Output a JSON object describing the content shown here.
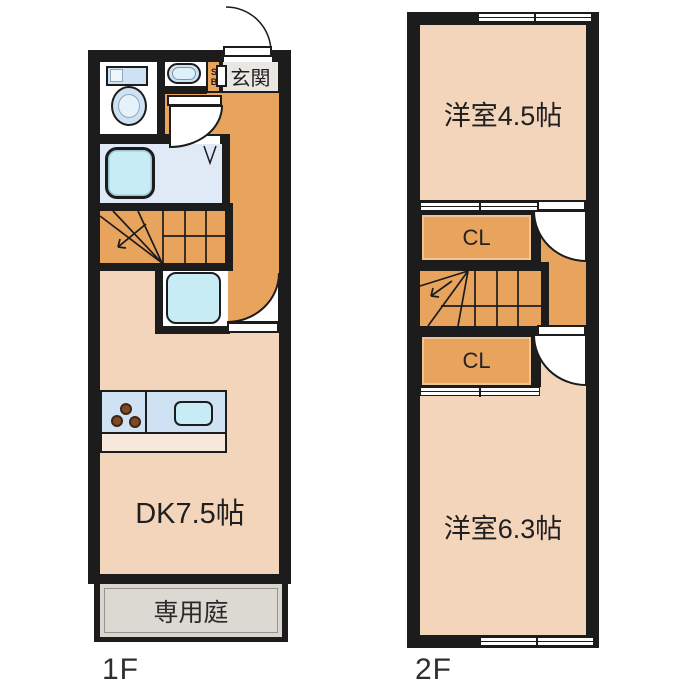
{
  "floors": {
    "f1": {
      "floor_label": "1F",
      "entrance_label": "玄関",
      "shoebox_label": "SB",
      "dk_label": "DK7.5帖",
      "garden_label": "専用庭"
    },
    "f2": {
      "floor_label": "2F",
      "room_top_label": "洋室4.5帖",
      "closet_top_label": "CL",
      "closet_bottom_label": "CL",
      "room_bottom_label": "洋室6.3帖"
    }
  },
  "colors": {
    "wall": "#1c1c1c",
    "room_peach": "#f3d5bb",
    "hall_orange": "#e8a45d",
    "bath_blue": "#dfeaf6",
    "fixture_blue": "#cfe2f3",
    "aqua": "#c8ecf6",
    "counter_front": "#f6e8da",
    "entry_gray": "#e9e7e2",
    "garden_gray": "#d9d6d0"
  }
}
